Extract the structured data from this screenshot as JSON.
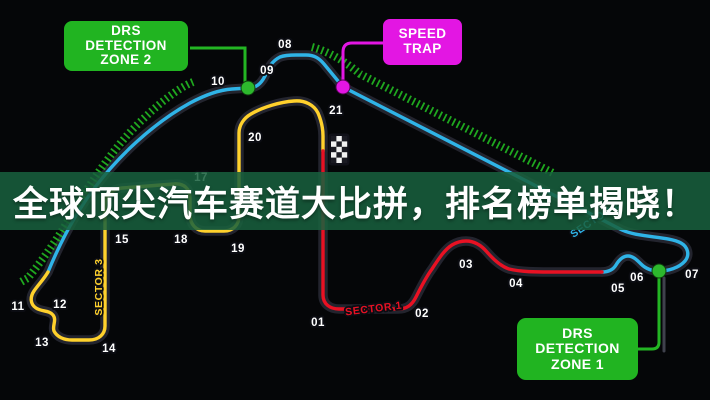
{
  "headline": {
    "text": "全球顶尖汽车赛道大比拼，排名榜单揭晓！"
  },
  "callouts": {
    "drs_zone_2": {
      "line1": "DRS",
      "line2": "DETECTION",
      "line3": "ZONE 2"
    },
    "speed_trap": {
      "line1": "SPEED",
      "line2": "TRAP"
    },
    "drs_zone_1": {
      "line1": "DRS",
      "line2": "DETECTION",
      "line3": "ZONE 1"
    }
  },
  "sectors": {
    "sector1": {
      "label": "SECTOR 1",
      "color": "#e81123"
    },
    "sector2": {
      "label": "SECTOR 2",
      "color": "#2fb4e8"
    },
    "sector3": {
      "label": "SECTOR 3",
      "color": "#ffd12c"
    }
  },
  "turns": {
    "t01": "01",
    "t02": "02",
    "t03": "03",
    "t04": "04",
    "t05": "05",
    "t06": "06",
    "t07": "07",
    "t08": "08",
    "t09": "09",
    "t10": "10",
    "t11": "11",
    "t12": "12",
    "t13": "13",
    "t14": "14",
    "t15": "15",
    "t17": "17",
    "t18": "18",
    "t19": "19",
    "t20": "20",
    "t21": "21"
  },
  "colors": {
    "background": "#050608",
    "sector1_red": "#e81123",
    "sector2_cyan": "#2fb4e8",
    "sector3_yellow": "#ffd12c",
    "drs_green": "#21b421",
    "hatch_green": "#1fa81f",
    "speed_trap_magenta": "#e316e3",
    "banner_green": "#196240"
  }
}
